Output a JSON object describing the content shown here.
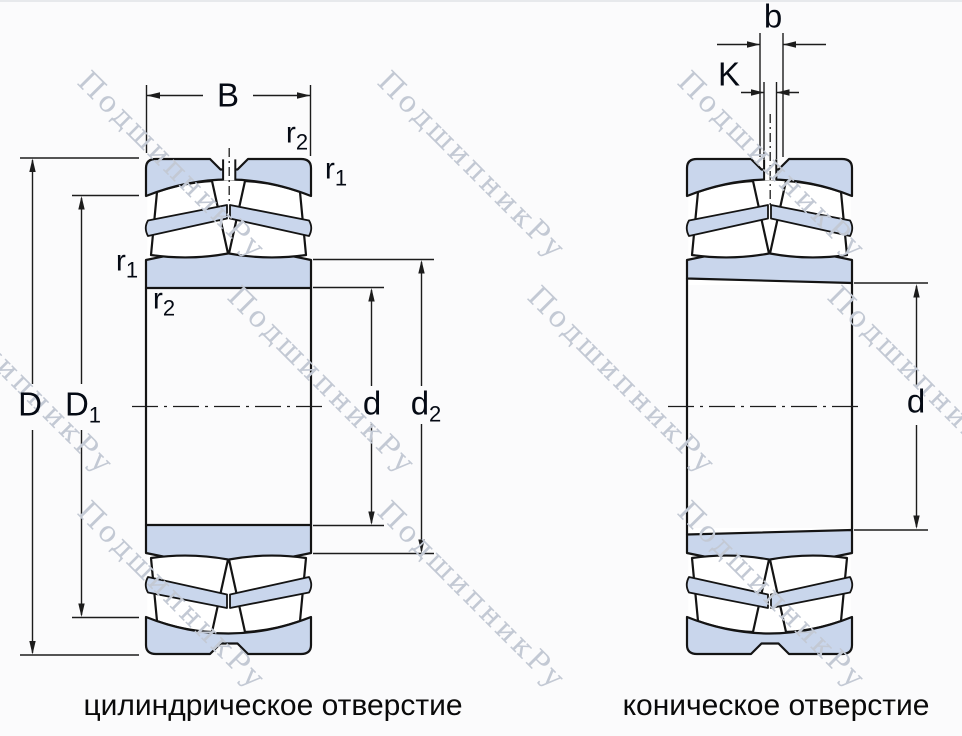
{
  "watermark": {
    "text": "ПодшипникРу"
  },
  "colors": {
    "bg_color": "#fbfbfc",
    "ring_fill": "#c9d6ec",
    "line_color": "#141414",
    "dim_color": "#1c1c1c",
    "label_color": "#050a14",
    "caption_color": "#0a0a0a",
    "wm_color": "#c3c9d4"
  },
  "views": {
    "left": {
      "caption": "цилиндрическое отверстие"
    },
    "right": {
      "caption": "коническое отверстие"
    }
  },
  "labels": {
    "B": {
      "base": "B",
      "sub": ""
    },
    "D": {
      "base": "D",
      "sub": ""
    },
    "D1": {
      "base": "D",
      "sub": "1"
    },
    "d": {
      "base": "d",
      "sub": ""
    },
    "d2": {
      "base": "d",
      "sub": "2"
    },
    "r1": {
      "base": "r",
      "sub": "1"
    },
    "r2": {
      "base": "r",
      "sub": "2"
    },
    "b": {
      "base": "b",
      "sub": ""
    },
    "K": {
      "base": "K",
      "sub": ""
    }
  }
}
